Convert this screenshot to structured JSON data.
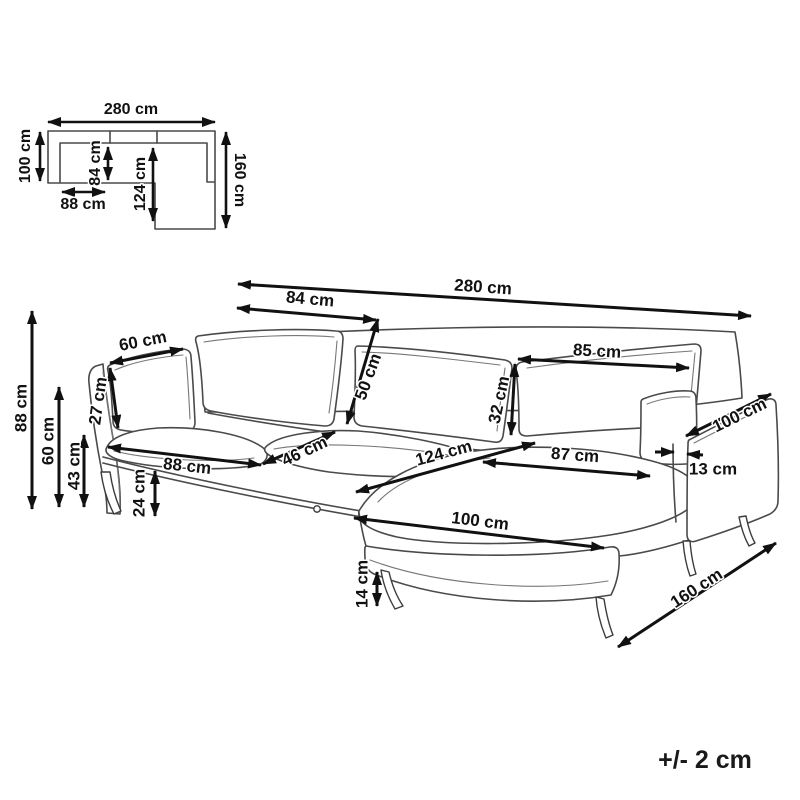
{
  "colors": {
    "background": "#ffffff",
    "line_art": "#4a4a4a",
    "dimension_lines": "#111111",
    "label_text": "#111111"
  },
  "tolerance_note": "+/- 2 cm",
  "top_view": {
    "description": "top-view-floorplan-of-corner-sofa",
    "dimensions": [
      {
        "label": "280 cm",
        "x1": 48,
        "y1": 122,
        "x2": 215,
        "y2": 122,
        "tx": 131,
        "ty": 110,
        "rot": 0,
        "fs": 16
      },
      {
        "label": "100 cm",
        "x1": 40,
        "y1": 132,
        "x2": 40,
        "y2": 181,
        "tx": 26,
        "ty": 156,
        "rot": -90,
        "fs": 16
      },
      {
        "label": "160 cm",
        "x1": 226,
        "y1": 132,
        "x2": 226,
        "y2": 228,
        "tx": 239,
        "ty": 180,
        "rot": 90,
        "fs": 16
      },
      {
        "label": "84 cm",
        "x1": 108,
        "y1": 147,
        "x2": 108,
        "y2": 180,
        "tx": 96,
        "ty": 163,
        "rot": -90,
        "fs": 16
      },
      {
        "label": "124 cm",
        "x1": 153,
        "y1": 148,
        "x2": 153,
        "y2": 221,
        "tx": 141,
        "ty": 184,
        "rot": -90,
        "fs": 16
      },
      {
        "label": "88 cm",
        "x1": 62,
        "y1": 192,
        "x2": 105,
        "y2": 192,
        "tx": 83,
        "ty": 205,
        "rot": 0,
        "fs": 16
      }
    ]
  },
  "perspective_view": {
    "description": "perspective-line-drawing-of-corner-sofa",
    "dimensions": [
      {
        "label": "280 cm",
        "x1": 238,
        "y1": 284,
        "x2": 751,
        "y2": 316,
        "tx": 483,
        "ty": 288,
        "rot": 4,
        "fs": 17
      },
      {
        "label": "84 cm",
        "x1": 237,
        "y1": 308,
        "x2": 376,
        "y2": 320,
        "tx": 310,
        "ty": 300,
        "rot": 5,
        "fs": 17
      },
      {
        "label": "50 cm",
        "x1": 378,
        "y1": 319,
        "x2": 347,
        "y2": 424,
        "tx": 369,
        "ty": 377,
        "rot": -70,
        "fs": 17
      },
      {
        "label": "85 cm",
        "x1": 518,
        "y1": 359,
        "x2": 689,
        "y2": 368,
        "tx": 597,
        "ty": 352,
        "rot": 3,
        "fs": 17
      },
      {
        "label": "32 cm",
        "x1": 515,
        "y1": 364,
        "x2": 511,
        "y2": 435,
        "tx": 500,
        "ty": 400,
        "rot": -78,
        "fs": 17
      },
      {
        "label": "100 cm",
        "x1": 686,
        "y1": 436,
        "x2": 771,
        "y2": 394,
        "tx": 740,
        "ty": 416,
        "rot": -26,
        "fs": 17
      },
      {
        "label": "13 cm",
        "x1": 655,
        "y1": 452,
        "x2": 674,
        "y2": 452,
        "heads": "end",
        "seg2": {
          "x1": 703,
          "y1": 455,
          "x2": 687,
          "y2": 454
        },
        "tx": 713,
        "ty": 470,
        "rot": 0,
        "fs": 17
      },
      {
        "label": "87 cm",
        "x1": 483,
        "y1": 462,
        "x2": 650,
        "y2": 476,
        "tx": 575,
        "ty": 456,
        "rot": 4,
        "fs": 17
      },
      {
        "label": "124 cm",
        "x1": 356,
        "y1": 492,
        "x2": 535,
        "y2": 443,
        "tx": 444,
        "ty": 454,
        "rot": -15,
        "fs": 17
      },
      {
        "label": "46 cm",
        "x1": 263,
        "y1": 464,
        "x2": 335,
        "y2": 432,
        "tx": 305,
        "ty": 452,
        "rot": -25,
        "fs": 17
      },
      {
        "label": "88 cm",
        "x1": 108,
        "y1": 447,
        "x2": 261,
        "y2": 465,
        "tx": 187,
        "ty": 467,
        "rot": 6,
        "fs": 17
      },
      {
        "label": "100 cm",
        "x1": 354,
        "y1": 518,
        "x2": 604,
        "y2": 548,
        "tx": 480,
        "ty": 522,
        "rot": 7,
        "fs": 17
      },
      {
        "label": "14 cm",
        "x1": 377,
        "y1": 572,
        "x2": 377,
        "y2": 606,
        "tx": 363,
        "ty": 584,
        "rot": -90,
        "fs": 17
      },
      {
        "label": "160 cm",
        "x1": 618,
        "y1": 647,
        "x2": 776,
        "y2": 543,
        "tx": 697,
        "ty": 589,
        "rot": -33,
        "fs": 17
      },
      {
        "label": "88 cm",
        "x1": 32,
        "y1": 311,
        "x2": 32,
        "y2": 509,
        "tx": 22,
        "ty": 408,
        "rot": -90,
        "fs": 17
      },
      {
        "label": "60 cm",
        "x1": 59,
        "y1": 387,
        "x2": 59,
        "y2": 507,
        "tx": 49,
        "ty": 441,
        "rot": -90,
        "fs": 17
      },
      {
        "label": "43 cm",
        "x1": 84,
        "y1": 435,
        "x2": 84,
        "y2": 507,
        "tx": 75,
        "ty": 466,
        "rot": -90,
        "fs": 17
      },
      {
        "label": "27 cm",
        "x1": 110,
        "y1": 368,
        "x2": 118,
        "y2": 428,
        "tx": 99,
        "ty": 401,
        "rot": -82,
        "fs": 17
      },
      {
        "label": "60 cm",
        "x1": 110,
        "y1": 363,
        "x2": 183,
        "y2": 349,
        "tx": 143,
        "ty": 342,
        "rot": -11,
        "fs": 17
      },
      {
        "label": "24 cm",
        "x1": 155,
        "y1": 471,
        "x2": 155,
        "y2": 516,
        "tx": 140,
        "ty": 493,
        "rot": -90,
        "fs": 17
      }
    ]
  }
}
